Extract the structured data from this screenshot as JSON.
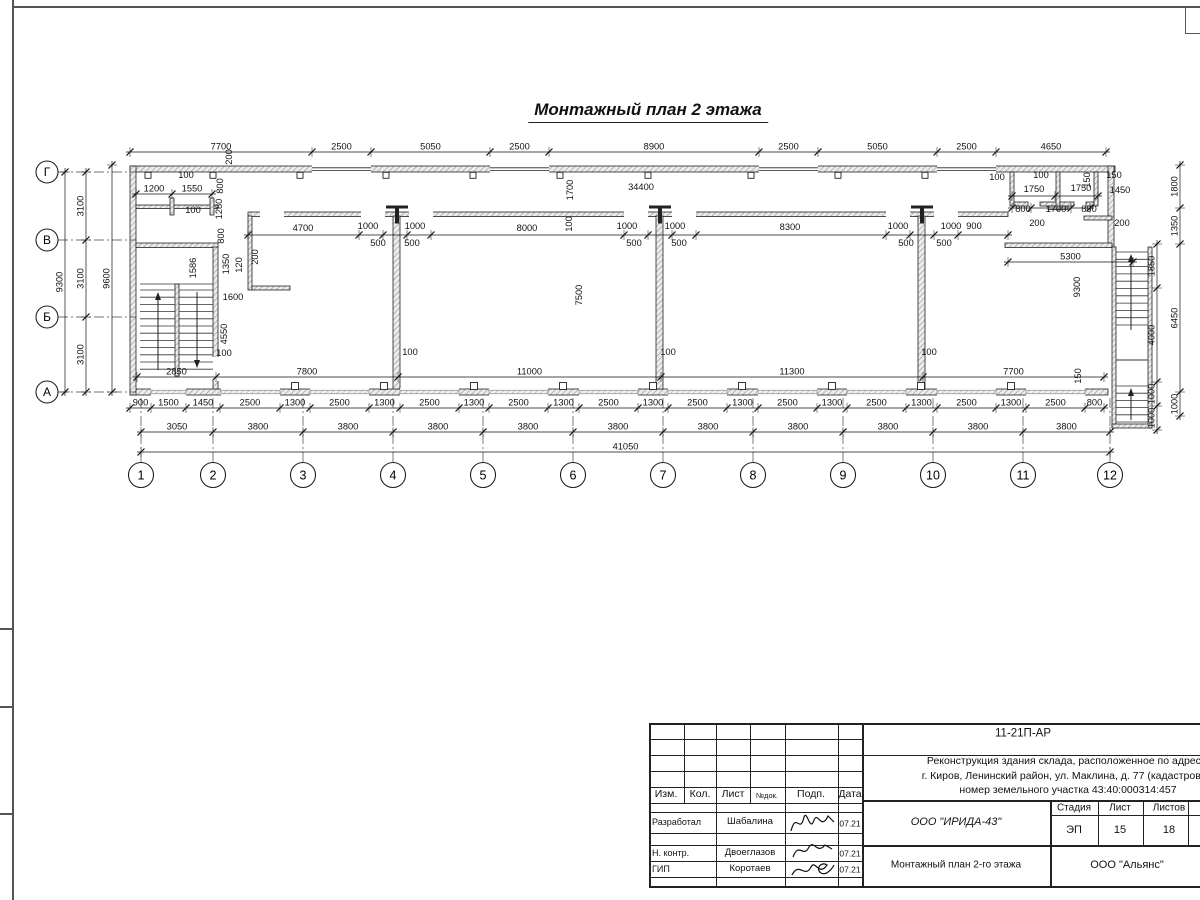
{
  "sheet": {
    "title": "Монтажный план 2 этажа"
  },
  "stamp": {
    "number": "11-21П-АР",
    "desc1": "Реконструкция здания склада, расположенное по адресу:",
    "desc2": "г. Киров, Ленинский район, ул. Маклина, д. 77 (кадастровый",
    "desc3": "номер земельного участка 43:40:000314:457",
    "col_izm": "Изм.",
    "col_kol": "Кол.",
    "col_list": "Лист",
    "col_ndok": "№док.",
    "col_podp": "Подп.",
    "col_data": "Дата",
    "role1": "Разработал",
    "name1": "Шабалина",
    "date1": "07.21",
    "role2": "Н. контр.",
    "name2": "Двоеглазов",
    "date2": "07.21",
    "role3": "ГИП",
    "name3": "Коротаев",
    "date3": "07.21",
    "org": "ООО \"ИРИДА-43\"",
    "drawing_title": "Монтажный план 2-го этажа",
    "contractor": "ООО \"Альянс\"",
    "stage_label": "Стадия",
    "list_label": "Лист",
    "listov_label": "Листов",
    "stage": "ЭП",
    "list": "15",
    "listov": "18"
  },
  "plan": {
    "axes_left": [
      {
        "t": "Г",
        "y": 172
      },
      {
        "t": "В",
        "y": 240
      },
      {
        "t": "Б",
        "y": 317
      },
      {
        "t": "А",
        "y": 392
      }
    ],
    "axes_bottom": [
      {
        "t": "1",
        "x": 141
      },
      {
        "t": "2",
        "x": 213
      },
      {
        "t": "3",
        "x": 303
      },
      {
        "t": "4",
        "x": 393
      },
      {
        "t": "5",
        "x": 483
      },
      {
        "t": "6",
        "x": 573
      },
      {
        "t": "7",
        "x": 663
      },
      {
        "t": "8",
        "x": 753
      },
      {
        "t": "9",
        "x": 843
      },
      {
        "t": "10",
        "x": 933
      },
      {
        "t": "11",
        "x": 1023
      },
      {
        "t": "12",
        "x": 1110
      }
    ],
    "chains": [
      {
        "o": "h",
        "p": 152,
        "t": [
          130,
          312,
          371,
          490,
          549,
          759,
          818,
          937,
          996,
          1106
        ],
        "l": [
          "7700",
          "2500",
          "5050",
          "2500",
          "8900",
          "2500",
          "5050",
          "2500",
          "4650"
        ]
      },
      {
        "o": "h",
        "p": 408,
        "t": [
          130,
          151,
          186,
          220,
          280,
          310,
          369,
          400,
          459,
          489,
          548,
          579,
          638,
          668,
          727,
          758,
          817,
          847,
          906,
          937,
          996,
          1026,
          1085,
          1104
        ],
        "l": [
          "900",
          "1500",
          "1450",
          "2500",
          "1300",
          "2500",
          "1300",
          "2500",
          "1300",
          "2500",
          "1300",
          "2500",
          "1300",
          "2500",
          "1300",
          "2500",
          "1300",
          "2500",
          "1300",
          "2500",
          "1300",
          "2500",
          "800"
        ]
      },
      {
        "o": "h",
        "p": 432,
        "t": [
          141,
          213,
          303,
          393,
          483,
          573,
          663,
          753,
          843,
          933,
          1023,
          1110
        ],
        "l": [
          "3050",
          "3800",
          "3800",
          "3800",
          "3800",
          "3800",
          "3800",
          "3800",
          "3800",
          "3800",
          "3800"
        ]
      },
      {
        "o": "h",
        "p": 452,
        "t": [
          141,
          1110
        ],
        "l": [
          "41050"
        ]
      },
      {
        "o": "v",
        "p": 65,
        "t": [
          172,
          392
        ],
        "l": [
          "9300"
        ]
      },
      {
        "o": "v",
        "p": 86,
        "t": [
          172,
          240,
          317,
          392
        ],
        "l": [
          "3100",
          "3100",
          "3100"
        ]
      },
      {
        "o": "v",
        "p": 112,
        "t": [
          165,
          392
        ],
        "l": [
          "9600"
        ]
      },
      {
        "o": "v",
        "p": 1157,
        "t": [
          244,
          288,
          382,
          406,
          430
        ],
        "l": [
          "1850",
          "4000",
          "1000",
          "1000"
        ]
      },
      {
        "o": "v",
        "p": 1180,
        "t": [
          165,
          208,
          244,
          392,
          416
        ],
        "l": [
          "1800",
          "1350",
          "6450",
          "1000"
        ]
      },
      {
        "o": "h",
        "p": 235,
        "t": [
          248,
          359,
          383,
          407,
          431,
          624,
          648,
          672,
          696,
          886,
          910,
          934,
          958,
          1008
        ],
        "l": []
      },
      {
        "o": "h",
        "p": 196,
        "t": [
          1012,
          1055,
          1098
        ],
        "l": []
      },
      {
        "o": "h",
        "p": 208,
        "t": [
          1012,
          1031,
          1071,
          1090
        ],
        "l": []
      },
      {
        "o": "h",
        "p": 377,
        "t": [
          137,
          216,
          398,
          661,
          923,
          1104
        ],
        "l": [
          "2850",
          "7800",
          "11000",
          "11300",
          "7700"
        ]
      },
      {
        "o": "h",
        "p": 194,
        "t": [
          136,
          172,
          212
        ],
        "l": [
          "1200",
          "1550"
        ]
      },
      {
        "o": "h",
        "p": 262,
        "t": [
          1008,
          1133
        ],
        "l": [
          "5300"
        ]
      }
    ],
    "labels": [
      {
        "x": 186,
        "y": 178,
        "t": "100"
      },
      {
        "x": 193,
        "y": 213,
        "t": "100"
      },
      {
        "x": 232,
        "y": 157,
        "t": "200",
        "r": 1
      },
      {
        "x": 223,
        "y": 186,
        "t": "800",
        "r": 1
      },
      {
        "x": 222,
        "y": 209,
        "t": "1280",
        "r": 1
      },
      {
        "x": 224,
        "y": 236,
        "t": "800",
        "r": 1
      },
      {
        "x": 229,
        "y": 264,
        "t": "1350",
        "r": 1
      },
      {
        "x": 242,
        "y": 265,
        "t": "120",
        "r": 1
      },
      {
        "x": 258,
        "y": 257,
        "t": "200",
        "r": 1
      },
      {
        "x": 196,
        "y": 268,
        "t": "1586",
        "r": 1
      },
      {
        "x": 233,
        "y": 300,
        "t": "1600"
      },
      {
        "x": 227,
        "y": 334,
        "t": "4550",
        "r": 1
      },
      {
        "x": 224,
        "y": 356,
        "t": "100"
      },
      {
        "x": 410,
        "y": 355,
        "t": "100"
      },
      {
        "x": 668,
        "y": 355,
        "t": "100"
      },
      {
        "x": 929,
        "y": 355,
        "t": "100"
      },
      {
        "x": 1081,
        "y": 376,
        "t": "150",
        "r": 1
      },
      {
        "x": 573,
        "y": 190,
        "t": "1700",
        "r": 1
      },
      {
        "x": 641,
        "y": 190,
        "t": "34400"
      },
      {
        "x": 572,
        "y": 224,
        "t": "100",
        "r": 1
      },
      {
        "x": 582,
        "y": 295,
        "t": "7500",
        "r": 1
      },
      {
        "x": 303,
        "y": 231,
        "t": "4700"
      },
      {
        "x": 368,
        "y": 229,
        "t": "1000"
      },
      {
        "x": 378,
        "y": 246,
        "t": "500"
      },
      {
        "x": 415,
        "y": 229,
        "t": "1000"
      },
      {
        "x": 412,
        "y": 246,
        "t": "500"
      },
      {
        "x": 527,
        "y": 231,
        "t": "8000"
      },
      {
        "x": 627,
        "y": 229,
        "t": "1000"
      },
      {
        "x": 634,
        "y": 246,
        "t": "500"
      },
      {
        "x": 675,
        "y": 229,
        "t": "1000"
      },
      {
        "x": 679,
        "y": 246,
        "t": "500"
      },
      {
        "x": 790,
        "y": 230,
        "t": "8300"
      },
      {
        "x": 898,
        "y": 229,
        "t": "1000"
      },
      {
        "x": 906,
        "y": 246,
        "t": "500"
      },
      {
        "x": 951,
        "y": 229,
        "t": "1000"
      },
      {
        "x": 944,
        "y": 246,
        "t": "500"
      },
      {
        "x": 974,
        "y": 229,
        "t": "900"
      },
      {
        "x": 997,
        "y": 180,
        "t": "100"
      },
      {
        "x": 1041,
        "y": 178,
        "t": "100"
      },
      {
        "x": 1034,
        "y": 192,
        "t": "1750"
      },
      {
        "x": 1081,
        "y": 191,
        "t": "1750"
      },
      {
        "x": 1090,
        "y": 180,
        "t": "150",
        "r": 1
      },
      {
        "x": 1114,
        "y": 178,
        "t": "150"
      },
      {
        "x": 1120,
        "y": 193,
        "t": "1450"
      },
      {
        "x": 1023,
        "y": 212,
        "t": "800"
      },
      {
        "x": 1056,
        "y": 212,
        "t": "1700"
      },
      {
        "x": 1089,
        "y": 212,
        "t": "800"
      },
      {
        "x": 1037,
        "y": 226,
        "t": "200"
      },
      {
        "x": 1122,
        "y": 226,
        "t": "200"
      },
      {
        "x": 1080,
        "y": 287,
        "t": "9300",
        "r": 1
      }
    ]
  }
}
